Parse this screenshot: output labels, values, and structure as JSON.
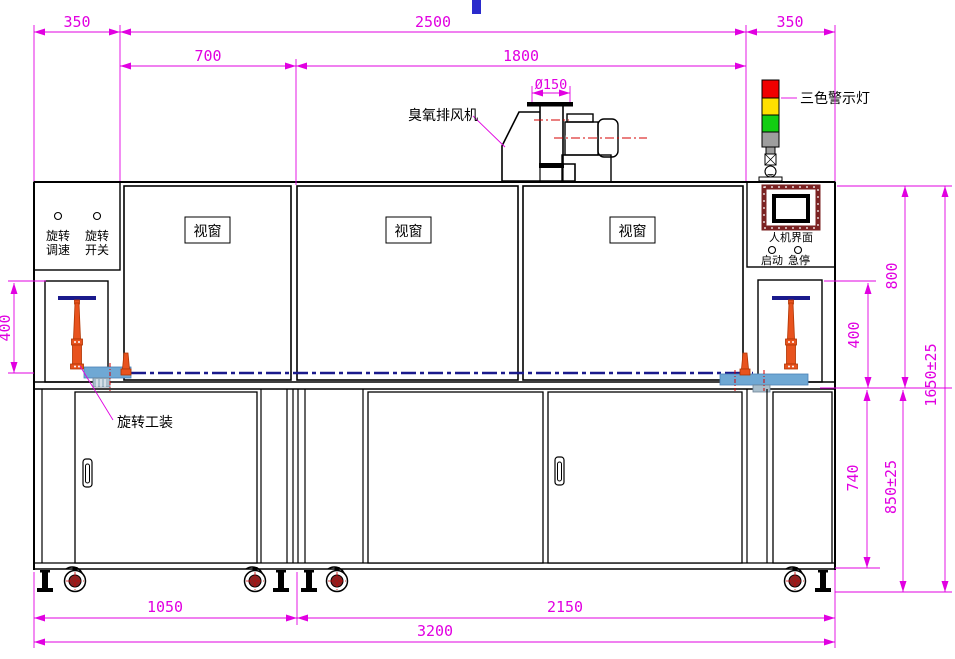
{
  "drawing": {
    "type": "engineering-front-view",
    "colors": {
      "dimension_magenta": "#E100E1",
      "line_black": "#000000",
      "conveyor_navy": "#1A1A8C",
      "fixture_orange": "#E8531E",
      "conveyor_blue": "#6FA8D4",
      "warn_red": "#F00000",
      "warn_yellow": "#FFE000",
      "warn_green": "#12CE12",
      "hmi_maroon": "#7B2222",
      "caster_maroon": "#8B2020",
      "centerline_red": "#D40000",
      "cursor_blue": "#2A2ACC"
    },
    "dims": {
      "d350_left": "350",
      "d2500": "2500",
      "d350_right": "350",
      "d700": "700",
      "d1800": "1800",
      "d150": "Ø150",
      "d400_left": "400",
      "d400_right": "400",
      "d800": "800",
      "d740": "740",
      "d850": "850±25",
      "d1650": "1650±25",
      "d1050": "1050",
      "d2150": "2150",
      "d3200": "3200"
    },
    "labels": {
      "ozone_fan": "臭氧排风机",
      "tricolor_light": "三色警示灯",
      "viewport1": "视窗",
      "viewport2": "视窗",
      "viewport3": "视窗",
      "rot_speed_l1": "旋转",
      "rot_speed_l2": "调速",
      "rot_switch_l1": "旋转",
      "rot_switch_l2": "开关",
      "hmi": "人机界面",
      "start_btn": "启动",
      "estop_btn": "急停",
      "rot_fixture": "旋转工装"
    }
  }
}
